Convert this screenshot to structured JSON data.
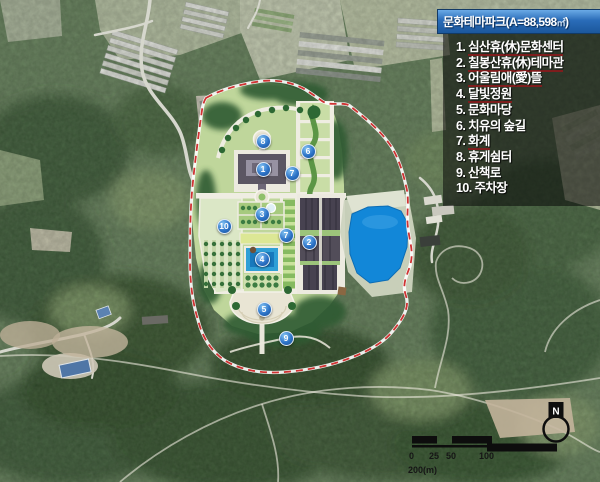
{
  "title": {
    "prefix": "문화테마파크(A=88,598",
    "unit": "㎡",
    "close": ")"
  },
  "legend": {
    "items": [
      {
        "no": "1.",
        "label": "심산휴(休)문화센터",
        "underline": true
      },
      {
        "no": "2.",
        "label": "칠봉산휴(休)테마관",
        "underline": true
      },
      {
        "no": "3.",
        "label": "어울림애(愛)뜰",
        "underline": true
      },
      {
        "no": "4.",
        "label": "달빛정원",
        "underline": true
      },
      {
        "no": "5.",
        "label": "문화마당",
        "underline": false
      },
      {
        "no": "6.",
        "label": "치유의 숲길",
        "underline": false
      },
      {
        "no": "7.",
        "label": "화계",
        "underline": true
      },
      {
        "no": "8.",
        "label": "휴게쉼터",
        "underline": false
      },
      {
        "no": "9.",
        "label": "산책로",
        "underline": false
      },
      {
        "no": "10.",
        "label": "주차장",
        "underline": false
      }
    ]
  },
  "map": {
    "markers": [
      {
        "num": "8",
        "x": 262,
        "y": 140
      },
      {
        "num": "1",
        "x": 262,
        "y": 168
      },
      {
        "num": "6",
        "x": 307,
        "y": 150
      },
      {
        "num": "7",
        "x": 291,
        "y": 172
      },
      {
        "num": "3",
        "x": 261,
        "y": 213
      },
      {
        "num": "10",
        "x": 223,
        "y": 225
      },
      {
        "num": "7",
        "x": 285,
        "y": 234
      },
      {
        "num": "2",
        "x": 308,
        "y": 241
      },
      {
        "num": "4",
        "x": 261,
        "y": 258
      },
      {
        "num": "5",
        "x": 263,
        "y": 308
      },
      {
        "num": "9",
        "x": 285,
        "y": 337
      }
    ]
  },
  "scalebar": {
    "labels": [
      "0",
      "25",
      "50",
      "100"
    ],
    "unit_label": "200(m)"
  },
  "north": {
    "label": "N"
  },
  "colors": {
    "title_bar_blue": "#2a6cb8",
    "marker_blue": "#2d74c8",
    "boundary_red": "#cf3333",
    "lake_blue": "#1287d8",
    "legend_underline_red": "#7e1d1d"
  }
}
